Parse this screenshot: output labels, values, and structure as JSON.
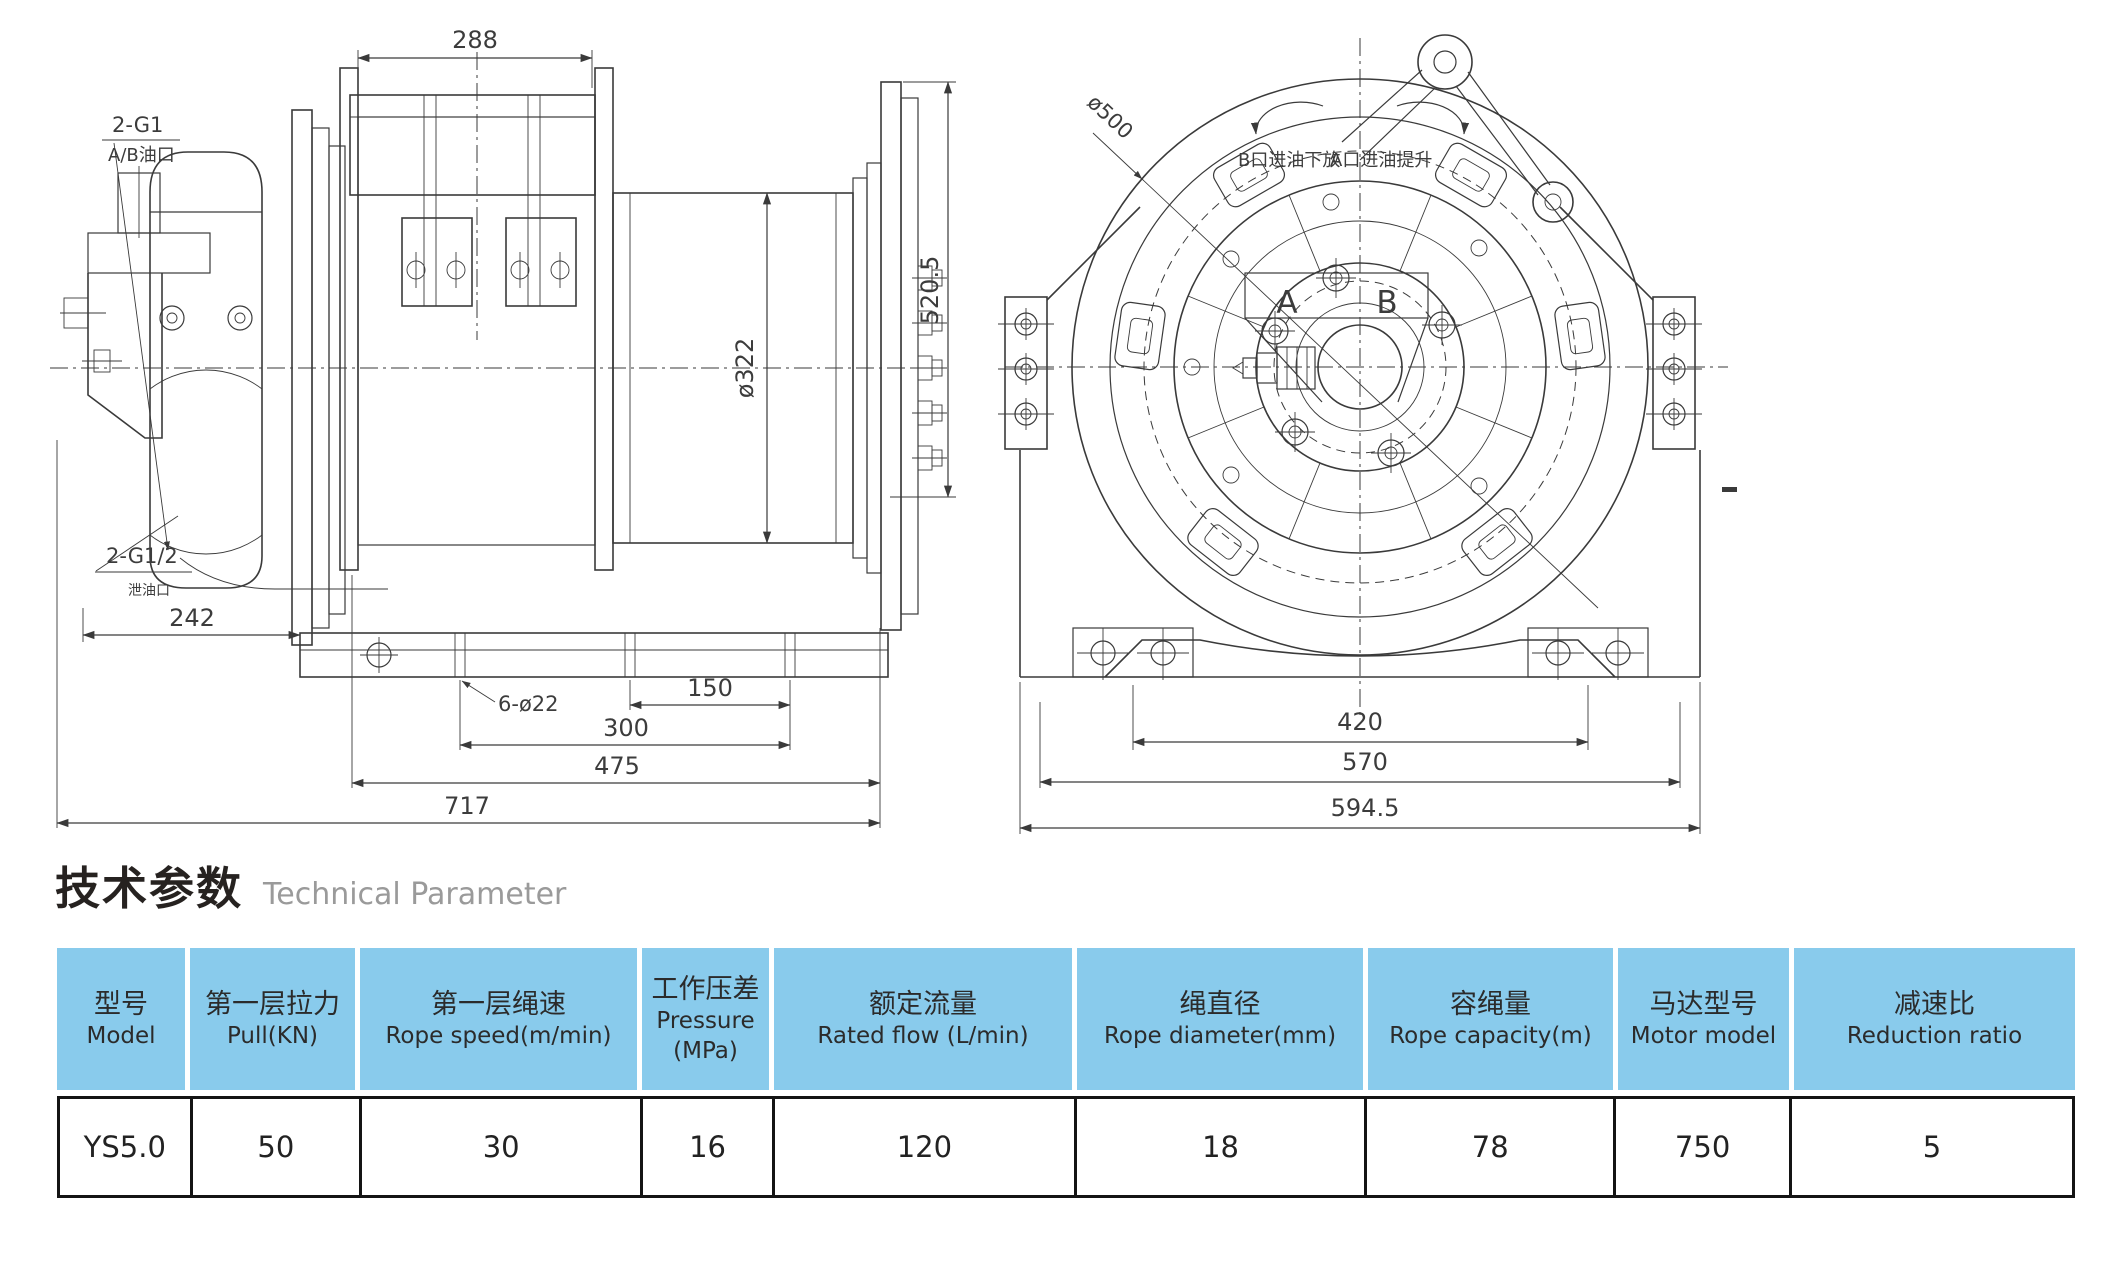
{
  "colors": {
    "line_color": "#3a3a3a",
    "table_header_bg": "#89CBEC",
    "table_border": "#141414",
    "heading_en_color": "#9a9a9a"
  },
  "side_view": {
    "labels": {
      "dim_top_width": "288",
      "dim_overall_height": "520.5",
      "dim_drum_diameter": "ø322",
      "port_label_line1": "2-G1",
      "port_label_line2": "A/B油口",
      "drain_label_line1": "2-G1/2",
      "drain_label_line2": "泄油口",
      "dim_motor_width": "242",
      "bolt_holes": "6-ø22",
      "dim_base_150": "150",
      "dim_base_300": "300",
      "dim_base_475": "475",
      "dim_overall_717": "717"
    }
  },
  "front_view": {
    "labels": {
      "dim_circle_diameter": "ø500",
      "rotation_note_b": "B口进油下放",
      "rotation_note_a": "A口进油提升",
      "port_a": "A",
      "port_b": "B",
      "dim_bolt_span": "420",
      "dim_base_570": "570",
      "dim_overall_594_5": "594.5",
      "stray_mark": "-"
    }
  },
  "section_heading": {
    "title_zh": "技术参数",
    "title_en": "Technical Parameter"
  },
  "parameters_table": {
    "columns": [
      {
        "zh": "型号",
        "en": "Model"
      },
      {
        "zh": "第一层拉力",
        "en": "Pull(KN)"
      },
      {
        "zh": "第一层绳速",
        "en": "Rope speed(m/min)"
      },
      {
        "zh": "工作压差",
        "en": "Pressure",
        "en2": "(MPa)"
      },
      {
        "zh": "额定流量",
        "en": "Rated flow (L/min)"
      },
      {
        "zh": "绳直径",
        "en": "Rope diameter(mm)"
      },
      {
        "zh": "容绳量",
        "en": "Rope capacity(m)"
      },
      {
        "zh": "马达型号",
        "en": "Motor model"
      },
      {
        "zh": "减速比",
        "en": "Reduction ratio"
      }
    ],
    "rows": [
      [
        "YS5.0",
        "50",
        "30",
        "16",
        "120",
        "18",
        "78",
        "750",
        "5"
      ]
    ]
  }
}
